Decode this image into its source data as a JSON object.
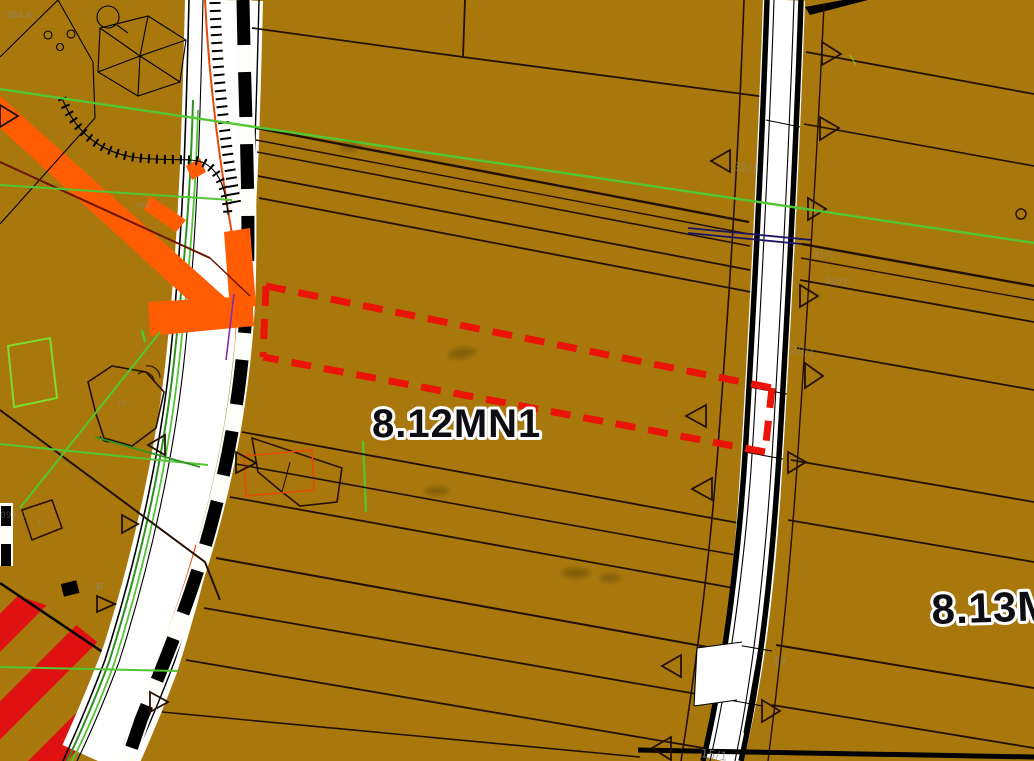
{
  "map": {
    "type": "zoning-plan-map",
    "zone_labels": {
      "main": "8.12MN1",
      "right_clipped": "8.13M"
    },
    "parcel_labels": [
      "32/1",
      "31/1",
      "30/1",
      "28/1",
      "17",
      "15/1"
    ],
    "annotations": [
      "384.8",
      "m2",
      "m",
      "t",
      "B",
      "093.0"
    ],
    "colors": {
      "ochre": "#a8780c",
      "road_white": "#ffffff",
      "line_black": "#000000",
      "parcel_line": "#241002",
      "selection_red": "#ea1408",
      "hatch_red": "#e01111",
      "orange": "#ff5c04",
      "orange_red_line": "#e8490b",
      "green_bright": "#52c633",
      "green_dark": "#2f9221",
      "green_deep": "#1c6e12",
      "green_light": "#7ddc2e",
      "khaki": "#b0a047",
      "navy": "#1b1464",
      "purple": "#8a2bb0",
      "maroon": "#6b1500",
      "label_gray": "#8f8c84"
    }
  }
}
